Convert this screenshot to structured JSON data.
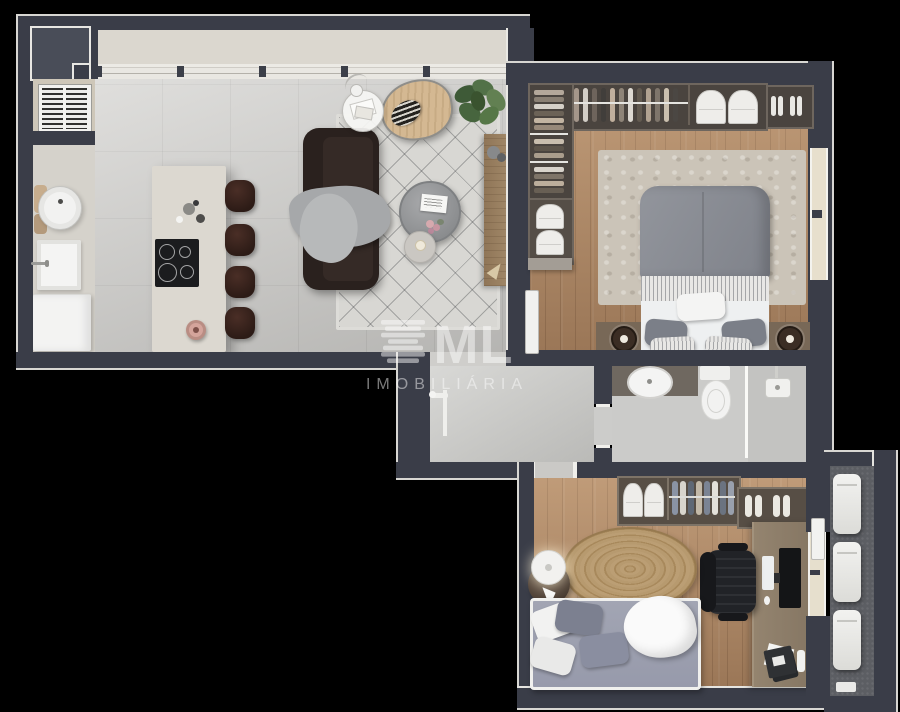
{
  "watermark": {
    "logo_text": "ML",
    "subtitle": "IMOBILIÁRIA",
    "icon": "stacked-slabs-logo",
    "color": "#ffffff"
  },
  "palette": {
    "background": "#000000",
    "wall": "#3a3d48",
    "wall_outline": "#d8d7d3",
    "floor_tile": "#d3d2cf",
    "floor_wood": "#b08763",
    "balcony_floor": "#5c5e63",
    "terrace_floor": "#dbd7cf",
    "sofa_brown": "#2e2521",
    "stool_brown": "#3d2520",
    "bed_gray": "#8b8e94",
    "bed_lavender": "#9b9eae",
    "rug_jute": "#b79a6f",
    "plant_green": "#527148",
    "armchair_tan": "#d4b892"
  }
}
